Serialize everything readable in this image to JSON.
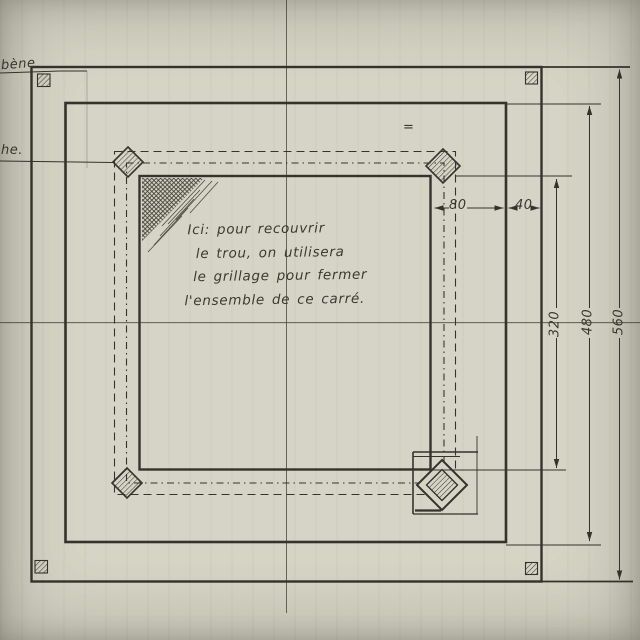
{
  "labels": {
    "left_top_partial": "bène",
    "left_mid_partial": "he.",
    "equals_mark": "="
  },
  "note": {
    "lines": [
      "Ici: pour recouvrir",
      "le trou, on utilisera",
      "le grillage pour fermer",
      "l'ensemble de ce carré."
    ]
  },
  "dimensions": {
    "gap_inner": "80",
    "gap_outer": "40",
    "inner_square": "320",
    "middle_square": "480",
    "outer_square": "560"
  },
  "colors": {
    "paper": "#d6d4c5",
    "ink": "#34332c"
  }
}
